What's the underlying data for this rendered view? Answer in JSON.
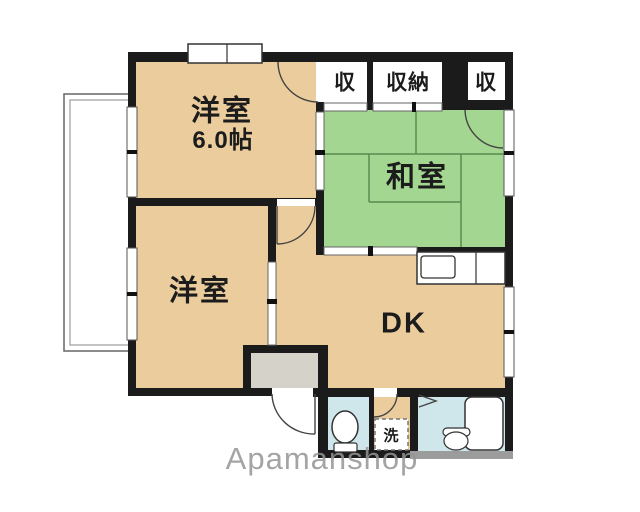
{
  "labels": {
    "western_room_top_name": "洋室",
    "western_room_top_size": "6.0帖",
    "western_room_bottom_name": "洋室",
    "japanese_room_name": "和室",
    "dining_kitchen_name": "DK",
    "closet_left": "収",
    "closet_center": "収納",
    "closet_right": "収",
    "laundry": "洗"
  },
  "watermark": "Apamanshop",
  "colors": {
    "room": "#ebcd9d",
    "tatami_room": "#a3d791",
    "closet": "#f7c3e2",
    "wet_area": "#cfe7ea",
    "entrance_floor": "#d5d2ca",
    "wall": "#1b1b1b",
    "wall_gray": "#9c9c9c",
    "tatami_line": "#5b8a50"
  }
}
